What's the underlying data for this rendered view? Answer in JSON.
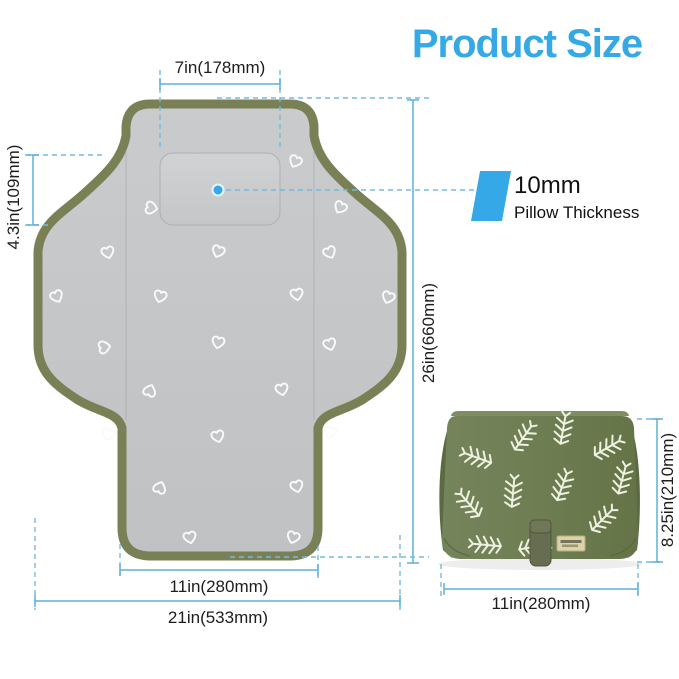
{
  "title": "Product Size",
  "colors": {
    "title_blue": "#35A8E6",
    "dimension_line_blue": "#5FAFDB",
    "accent_blue": "#35A8E8",
    "pad_gray": "#C5C7C9",
    "pad_border_olive": "#798055",
    "bag_green": "#6E7D52"
  },
  "open_pad": {
    "pillow_width": "7in(178mm)",
    "pillow_height": "4.3in(109mm)",
    "length": "26in(660mm)",
    "bottom_width": "11in(280mm)",
    "total_width": "21in(533mm)"
  },
  "pillow_callout": {
    "thickness": "10mm",
    "label": "Pillow Thickness"
  },
  "folded_pad": {
    "height": "8.25in(210mm)",
    "width": "11in(280mm)"
  }
}
